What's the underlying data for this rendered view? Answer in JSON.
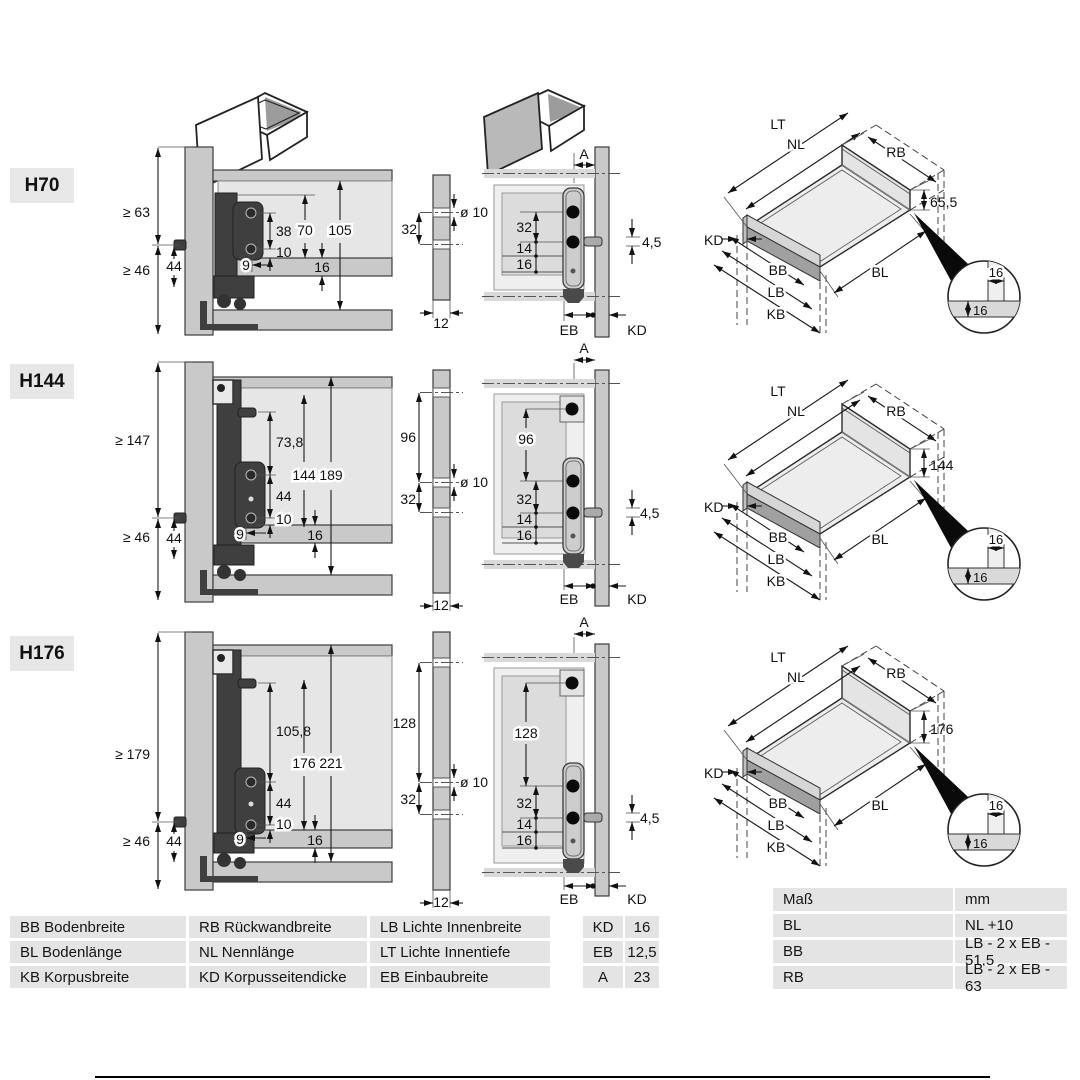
{
  "rows": [
    {
      "label": "H70",
      "left": {
        "ge_top": "≥ 63",
        "ge_bottom": "≥ 46",
        "d44": "44",
        "span_screws": "38",
        "d10": "10",
        "d9": "9",
        "h_inner": "70",
        "h_total": "105",
        "t16": "16"
      },
      "mid": {
        "pitch": "32",
        "bore": "ø 10",
        "thickness": "12"
      },
      "right": {
        "a": "A",
        "pitch": "32",
        "d14": "14",
        "d16": "16",
        "pin": "4,5",
        "eb": "EB",
        "kd": "KD"
      },
      "iso": {
        "lt": "LT",
        "nl": "NL",
        "rb": "RB",
        "height": "65,5",
        "kd": "KD",
        "bb": "BB",
        "lb": "LB",
        "kb": "KB",
        "bl": "BL",
        "det_a": "16",
        "det_b": "16"
      }
    },
    {
      "label": "H144",
      "left": {
        "ge_top": "≥ 147",
        "ge_bottom": "≥ 46",
        "d44": "44",
        "span_top": "73,8",
        "span_screws": "44",
        "d10": "10",
        "d9": "9",
        "h_inner": "144",
        "h_total": "189",
        "t16": "16"
      },
      "mid": {
        "top_pitch": "96",
        "pitch": "32",
        "bore": "ø 10",
        "thickness": "12"
      },
      "right": {
        "a": "A",
        "top_pitch": "96",
        "pitch": "32",
        "d14": "14",
        "d16": "16",
        "pin": "4,5",
        "eb": "EB",
        "kd": "KD"
      },
      "iso": {
        "lt": "LT",
        "nl": "NL",
        "rb": "RB",
        "height": "144",
        "kd": "KD",
        "bb": "BB",
        "lb": "LB",
        "kb": "KB",
        "bl": "BL",
        "det_a": "16",
        "det_b": "16"
      }
    },
    {
      "label": "H176",
      "left": {
        "ge_top": "≥ 179",
        "ge_bottom": "≥ 46",
        "d44": "44",
        "span_top": "105,8",
        "span_screws": "44",
        "d10": "10",
        "d9": "9",
        "h_inner": "176",
        "h_total": "221",
        "t16": "16"
      },
      "mid": {
        "top_pitch": "128",
        "pitch": "32",
        "bore": "ø 10",
        "thickness": "12"
      },
      "right": {
        "a": "A",
        "top_pitch": "128",
        "pitch": "32",
        "d14": "14",
        "d16": "16",
        "pin": "4,5",
        "eb": "EB",
        "kd": "KD"
      },
      "iso": {
        "lt": "LT",
        "nl": "NL",
        "rb": "RB",
        "height": "176",
        "kd": "KD",
        "bb": "BB",
        "lb": "LB",
        "kb": "KB",
        "bl": "BL",
        "det_a": "16",
        "det_b": "16"
      }
    }
  ],
  "legend": {
    "cells": [
      [
        "BB Bodenbreite",
        "RB Rückwandbreite",
        "LB Lichte Innenbreite"
      ],
      [
        "BL Bodenlänge",
        "NL Nennlänge",
        "LT Lichte Innentiefe"
      ],
      [
        "KB Korpusbreite",
        "KD Korpusseitendicke",
        "EB Einbaubreite"
      ]
    ]
  },
  "values_table": {
    "rows": [
      [
        "KD",
        "16"
      ],
      [
        "EB",
        "12,5"
      ],
      [
        "A",
        "23"
      ]
    ]
  },
  "mass_table": {
    "header": [
      "Maß",
      "mm"
    ],
    "rows": [
      [
        "BL",
        "NL +10"
      ],
      [
        "BB",
        "LB - 2 x EB - 51,5"
      ],
      [
        "RB",
        "LB - 2 x EB - 63"
      ]
    ]
  }
}
